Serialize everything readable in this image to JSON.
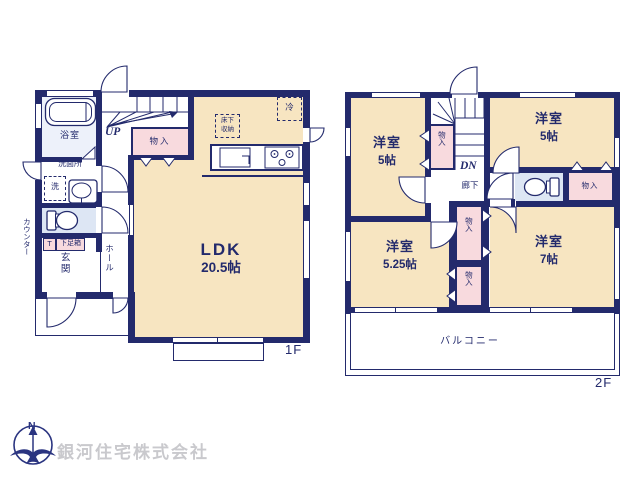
{
  "colors": {
    "wall": "#232a6c",
    "room_cream": "#f7e5c1",
    "closet_pink": "#f8dade",
    "water_blue": "#dde6f4",
    "bath_blue": "#edf1fa",
    "company_gray": "#c9c9cd",
    "compass_navy": "#2a3480"
  },
  "floor1": {
    "floor_label": "1F",
    "ldk": {
      "name": "LDK",
      "size": "20.5帖"
    },
    "bathroom": "浴室",
    "washroom": "洗面所",
    "washer": "洗",
    "toilet_counter": "カウンター",
    "toilet_t": "T",
    "shoe_box": "下足箱",
    "entrance": "玄関",
    "hall": "ホール",
    "closet": "物入",
    "stairs_up": "UP",
    "fridge": "冷",
    "underfloor_storage_line1": "床下",
    "underfloor_storage_line2": "収納"
  },
  "floor2": {
    "floor_label": "2F",
    "rooms": [
      {
        "name": "洋室",
        "size": "5帖"
      },
      {
        "name": "洋室",
        "size": "5帖"
      },
      {
        "name": "洋室",
        "size": "5.25帖"
      },
      {
        "name": "洋室",
        "size": "7帖"
      }
    ],
    "closets": [
      "物入",
      "物入",
      "物入",
      "物入"
    ],
    "stairs_down": "DN",
    "corridor": "廊下",
    "balcony": "バルコニー"
  },
  "footer": {
    "compass_north": "N",
    "company": "銀河住宅株式会社"
  }
}
